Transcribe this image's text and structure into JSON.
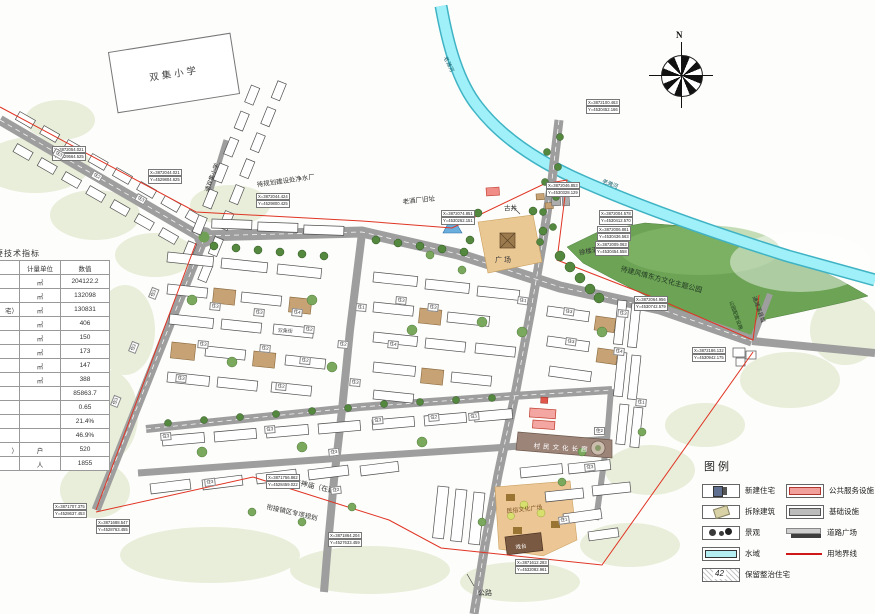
{
  "school": {
    "label": "双集小学"
  },
  "compass": {
    "north_label": "N"
  },
  "table": {
    "title": "主要技术指标",
    "headers": {
      "name": "",
      "unit": "计量单位",
      "value": "数值"
    },
    "rows": [
      {
        "name": "",
        "unit": "㎡",
        "value": "204122.2"
      },
      {
        "name": "",
        "unit": "㎡",
        "value": "132098"
      },
      {
        "name": "宅）",
        "unit": "㎡",
        "value": "130831"
      },
      {
        "name": "",
        "unit": "㎡",
        "value": "406"
      },
      {
        "name": "",
        "unit": "㎡",
        "value": "150"
      },
      {
        "name": "",
        "unit": "㎡",
        "value": "173"
      },
      {
        "name": "",
        "unit": "㎡",
        "value": "147"
      },
      {
        "name": "",
        "unit": "㎡",
        "value": "388"
      },
      {
        "name": "",
        "unit": "",
        "value": "85863.7"
      },
      {
        "name": "",
        "unit": "",
        "value": "0.65"
      },
      {
        "name": "",
        "unit": "",
        "value": "21.4%"
      },
      {
        "name": "",
        "unit": "",
        "value": "46.9%"
      },
      {
        "name": "）",
        "unit": "户",
        "value": "520"
      },
      {
        "name": "",
        "unit": "人",
        "value": "1855"
      }
    ]
  },
  "legend": {
    "title": "图例",
    "left": [
      {
        "key": "new-residential",
        "label": "新建住宅"
      },
      {
        "key": "demolish",
        "label": "拆除建筑"
      },
      {
        "key": "landscape",
        "label": "景观"
      },
      {
        "key": "water",
        "label": "水域"
      },
      {
        "key": "retain",
        "label": "保留整治住宅",
        "badge": "42"
      }
    ],
    "right": [
      {
        "key": "public-service",
        "label": "公共服务设施"
      },
      {
        "key": "infrastructure",
        "label": "基础设施"
      },
      {
        "key": "road-plaza",
        "label": "道路广场"
      },
      {
        "key": "boundary",
        "label": "用地界线"
      }
    ]
  },
  "map": {
    "labels": [
      {
        "text": "通双集小学",
        "x": 202,
        "y": 190,
        "rot": -70,
        "size": 6
      },
      {
        "text": "待规划建设处净水厂",
        "x": 256,
        "y": 179,
        "rot": -8,
        "size": 6.5
      },
      {
        "text": "老酒厂旧址",
        "x": 402,
        "y": 196,
        "rot": -6,
        "size": 6.5
      },
      {
        "text": "古井",
        "x": 504,
        "y": 202,
        "rot": 0,
        "size": 6.5
      },
      {
        "text": "广场",
        "x": 495,
        "y": 255,
        "rot": 0,
        "size": 7,
        "ls": 2
      },
      {
        "text": "徐楼酒厂",
        "x": 578,
        "y": 247,
        "rot": -10,
        "size": 6.5
      },
      {
        "text": "待建风情东方文化主题公园",
        "x": 622,
        "y": 264,
        "rot": 15,
        "size": 7,
        "color": "#233a23"
      },
      {
        "text": "老濉河",
        "x": 449,
        "y": 55,
        "rot": 64,
        "size": 5.5,
        "color": "#17606e"
      },
      {
        "text": "老濉河",
        "x": 604,
        "y": 177,
        "rot": 21,
        "size": 5.5,
        "color": "#17606e"
      },
      {
        "text": "村民文化长廊",
        "x": 534,
        "y": 440,
        "rot": 4,
        "size": 6.5,
        "color": "#ffffff",
        "ls": 3
      },
      {
        "text": "民俗文化广场",
        "x": 506,
        "y": 506,
        "rot": -6,
        "size": 6,
        "color": "#7a5320"
      },
      {
        "text": "戏台",
        "x": 515,
        "y": 543,
        "rot": -7,
        "size": 5.5,
        "color": "#ffffff"
      },
      {
        "text": "天神庙（在建）",
        "x": 295,
        "y": 477,
        "rot": 13,
        "size": 7
      },
      {
        "text": "衔接镇区专项规划",
        "x": 268,
        "y": 501,
        "rot": 13,
        "size": 6.5
      },
      {
        "text": "公路",
        "x": 478,
        "y": 588,
        "rot": 0,
        "size": 7
      },
      {
        "text": "通濉溪县城",
        "x": 758,
        "y": 295,
        "rot": 70,
        "size": 5.5
      },
      {
        "text": "公园配套设施",
        "x": 734,
        "y": 300,
        "rot": 70,
        "size": 5,
        "color": "#1d3a1d"
      },
      {
        "text": "双集街",
        "x": 278,
        "y": 327,
        "rot": 3,
        "size": 5,
        "color": "#555555"
      }
    ],
    "coords": [
      {
        "x": 52,
        "y": 146,
        "x_text": "X=3872054.021",
        "y_text": "Y=4529564.525"
      },
      {
        "x": 148,
        "y": 169,
        "x_text": "X=3872044.021",
        "y_text": "Y=4529804.625"
      },
      {
        "x": 256,
        "y": 193,
        "x_text": "X=3872044.424",
        "y_text": "Y=4529800.425"
      },
      {
        "x": 441,
        "y": 210,
        "x_text": "X=3872074.851",
        "y_text": "Y=4530262.151"
      },
      {
        "x": 546,
        "y": 182,
        "x_text": "X=3872046.853",
        "y_text": "Y=4530328.129"
      },
      {
        "x": 586,
        "y": 99,
        "x_text": "X=3872100.463",
        "y_text": "Y=4530452.166"
      },
      {
        "x": 599,
        "y": 210,
        "x_text": "X=3872004.578",
        "y_text": "Y=4530412.570"
      },
      {
        "x": 597,
        "y": 226,
        "x_text": "X=3872006.881",
        "y_text": "Y=4530436.563"
      },
      {
        "x": 595,
        "y": 241,
        "x_text": "X=3872009.063",
        "y_text": "Y=4530454.558"
      },
      {
        "x": 634,
        "y": 296,
        "x_text": "X=3872064.956",
        "y_text": "Y=4530742.579"
      },
      {
        "x": 53,
        "y": 503,
        "x_text": "X=3871707.375",
        "y_text": "Y=4528637.453"
      },
      {
        "x": 96,
        "y": 519,
        "x_text": "X=3871688.547",
        "y_text": "Y=4528763.455"
      },
      {
        "x": 266,
        "y": 474,
        "x_text": "X=3871756.862",
        "y_text": "Y=4528459.022"
      },
      {
        "x": 328,
        "y": 532,
        "x_text": "X=3871864.204",
        "y_text": "Y=4527633.459"
      },
      {
        "x": 515,
        "y": 559,
        "x_text": "X=3871612.283",
        "y_text": "Y=4532082.961"
      },
      {
        "x": 692,
        "y": 347,
        "x_text": "X=3872186.132",
        "y_text": "Y=4530942.175"
      }
    ],
    "bld_labels": [
      {
        "text": "住3",
        "x": 210,
        "y": 302,
        "rot": 6
      },
      {
        "text": "住3",
        "x": 254,
        "y": 308,
        "rot": 6
      },
      {
        "text": "住2",
        "x": 304,
        "y": 325,
        "rot": 6
      },
      {
        "text": "住1",
        "x": 356,
        "y": 303,
        "rot": 6
      },
      {
        "text": "住3",
        "x": 396,
        "y": 296,
        "rot": 6
      },
      {
        "text": "住3",
        "x": 428,
        "y": 303,
        "rot": 6
      },
      {
        "text": "住1",
        "x": 518,
        "y": 296,
        "rot": 8
      },
      {
        "text": "住2",
        "x": 260,
        "y": 344,
        "rot": 6
      },
      {
        "text": "住4",
        "x": 292,
        "y": 308,
        "rot": 6
      },
      {
        "text": "住3",
        "x": 198,
        "y": 340,
        "rot": 6
      },
      {
        "text": "住2",
        "x": 300,
        "y": 356,
        "rot": 6
      },
      {
        "text": "住4",
        "x": 388,
        "y": 340,
        "rot": 6
      },
      {
        "text": "住3",
        "x": 350,
        "y": 378,
        "rot": 6
      },
      {
        "text": "住2",
        "x": 338,
        "y": 340,
        "rot": 6
      },
      {
        "text": "住3",
        "x": 176,
        "y": 374,
        "rot": 6
      },
      {
        "text": "住2",
        "x": 276,
        "y": 382,
        "rot": 6
      },
      {
        "text": "住1",
        "x": 468,
        "y": 413,
        "rot": -5
      },
      {
        "text": "住3",
        "x": 160,
        "y": 433,
        "rot": -5
      },
      {
        "text": "住3",
        "x": 264,
        "y": 426,
        "rot": -5
      },
      {
        "text": "住2",
        "x": 428,
        "y": 414,
        "rot": -5
      },
      {
        "text": "住3",
        "x": 372,
        "y": 417,
        "rot": -5
      },
      {
        "text": "住3",
        "x": 328,
        "y": 449,
        "rot": -7
      },
      {
        "text": "住2",
        "x": 330,
        "y": 487,
        "rot": -7
      },
      {
        "text": "住3",
        "x": 204,
        "y": 479,
        "rot": -7
      },
      {
        "text": "住1",
        "x": 558,
        "y": 517,
        "rot": -8
      },
      {
        "text": "住3",
        "x": 584,
        "y": 464,
        "rot": -6
      },
      {
        "text": "住2",
        "x": 594,
        "y": 427,
        "rot": 0
      },
      {
        "text": "住3",
        "x": 564,
        "y": 307,
        "rot": 8
      },
      {
        "text": "住3",
        "x": 566,
        "y": 337,
        "rot": 8
      },
      {
        "text": "住4",
        "x": 614,
        "y": 347,
        "rot": 6
      },
      {
        "text": "住3",
        "x": 618,
        "y": 309,
        "rot": 6
      },
      {
        "text": "住1",
        "x": 636,
        "y": 398,
        "rot": 6
      },
      {
        "text": "住3",
        "x": 56,
        "y": 148,
        "rot": 30
      },
      {
        "text": "住2",
        "x": 94,
        "y": 170,
        "rot": 30
      },
      {
        "text": "住3",
        "x": 138,
        "y": 193,
        "rot": 30
      },
      {
        "text": "住3",
        "x": 148,
        "y": 297,
        "rot": -68
      },
      {
        "text": "住2",
        "x": 128,
        "y": 351,
        "rot": -68
      },
      {
        "text": "住3",
        "x": 110,
        "y": 405,
        "rot": -68
      }
    ]
  },
  "colors": {
    "water": "#9ff0f8",
    "water_edge": "#3fb3c4",
    "park": "#6ca355",
    "road": "#9e9e9e",
    "boundary_line": "#e03424",
    "sand_plaza": "#eac893",
    "public_service": "#f2a09c"
  }
}
